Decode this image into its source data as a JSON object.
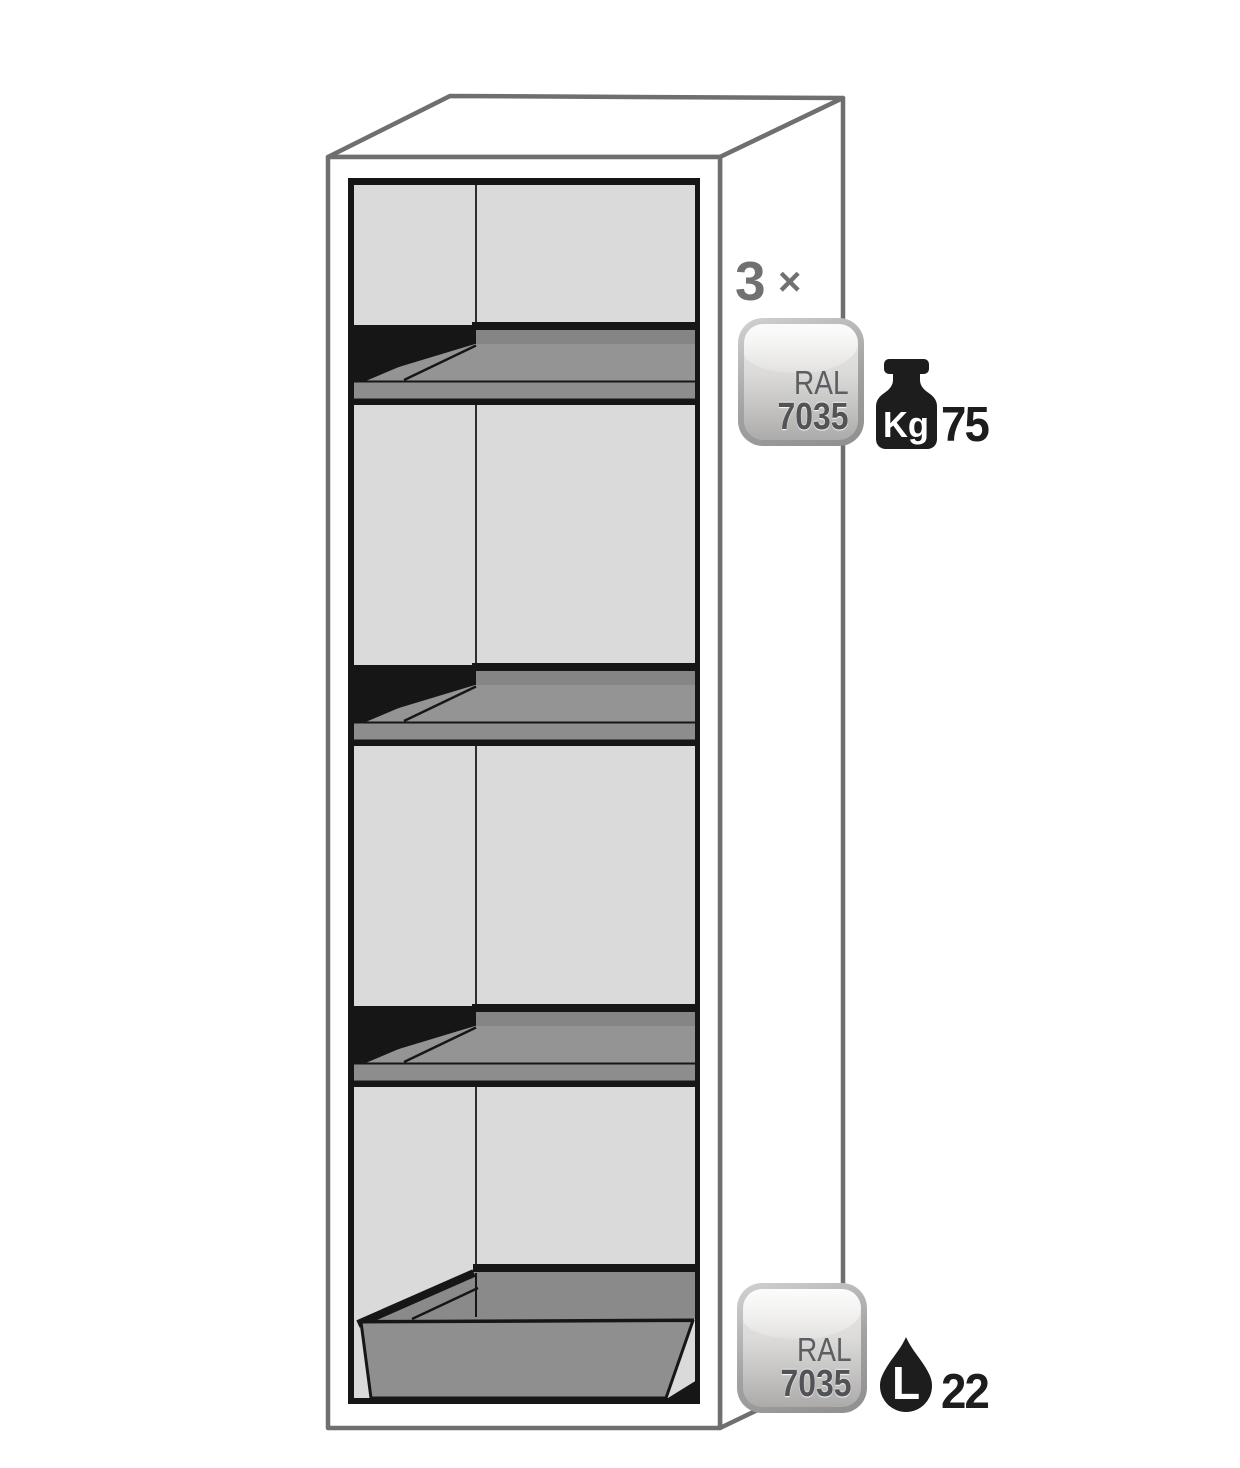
{
  "diagram": {
    "shelf_count": {
      "value": "3",
      "multiplier_symbol": "×"
    },
    "shelf_color_badge": {
      "line1": "RAL",
      "line2": "7035"
    },
    "shelf_load_capacity": {
      "icon": "weight-kg-icon",
      "unit_label": "Kg",
      "value": "75"
    },
    "sump_color_badge": {
      "line1": "RAL",
      "line2": "7035"
    },
    "sump_volume": {
      "icon": "liter-drop-icon",
      "unit_label": "L",
      "value": "22"
    }
  },
  "colors": {
    "background": "#ffffff",
    "outline_dark": "#161616",
    "outline_gray": "#6f6f6f",
    "interior_wall": "#dadada",
    "shelf_surface": "#949494",
    "shelf_back_edge": "#858585",
    "sump_front": "#8f8f8f",
    "badge_number_text": "#525356",
    "count_label_gray": "#717171",
    "icon_black": "#1d1d1e"
  }
}
